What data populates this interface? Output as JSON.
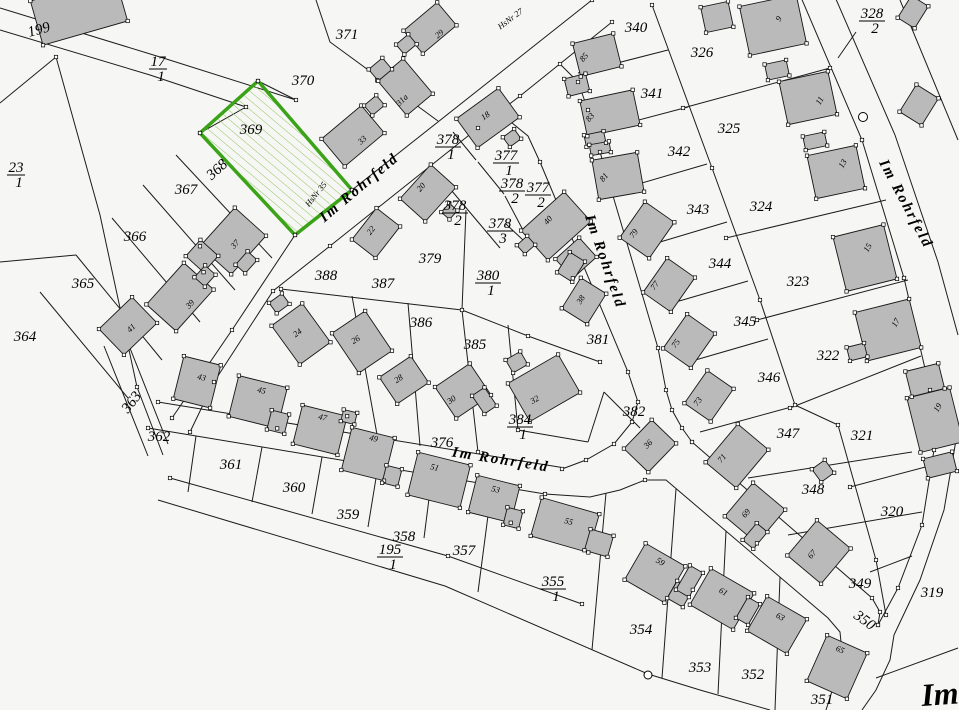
{
  "colors": {
    "background": "#f6f6f4",
    "line": "#1c1c1c",
    "building_fill": "#bababa",
    "highlight_border": "#3aa317",
    "hatch": "#8fc75c",
    "corner_label": "#5c1111"
  },
  "street_labels": {
    "name": "Im Rohrfeld",
    "hsnr27": "HsNr 27",
    "hsnr35": "HsNr 35",
    "corner": "Im"
  },
  "highlighted_parcel": "369",
  "parcel_labels": [
    "199",
    "371",
    "370",
    "369",
    "368",
    "367",
    "366",
    "365",
    "364",
    "363",
    "362",
    "361",
    "360",
    "359",
    "358",
    "357",
    "354",
    "353",
    "352",
    "351",
    "376",
    "388",
    "387",
    "386",
    "385",
    "379",
    "381",
    "382",
    "340",
    "326",
    "341",
    "325",
    "342",
    "324",
    "343",
    "344",
    "323",
    "345",
    "322",
    "346",
    "347",
    "321",
    "348",
    "320",
    "349",
    "319",
    "350"
  ],
  "fraction_labels": [
    {
      "num": "17",
      "den": "1"
    },
    {
      "num": "23",
      "den": "1"
    },
    {
      "num": "328",
      "den": "2"
    },
    {
      "num": "378",
      "den": "1"
    },
    {
      "num": "377",
      "den": "1"
    },
    {
      "num": "378",
      "den": "2"
    },
    {
      "num": "377",
      "den": "2"
    },
    {
      "num": "378",
      "den": "2"
    },
    {
      "num": "378",
      "den": "3"
    },
    {
      "num": "380",
      "den": "1"
    },
    {
      "num": "384",
      "den": "1"
    },
    {
      "num": "355",
      "den": "1"
    },
    {
      "num": "195",
      "den": "1"
    }
  ],
  "house_numbers": [
    "29",
    "31a",
    "33",
    "18",
    "20",
    "22",
    "40",
    "38",
    "36",
    "24",
    "26",
    "28",
    "30",
    "32",
    "37",
    "39",
    "41",
    "43",
    "45",
    "47",
    "49",
    "51",
    "53",
    "55",
    "59",
    "61",
    "63",
    "65",
    "67",
    "69",
    "71",
    "73",
    "75",
    "77",
    "79",
    "81",
    "83",
    "85",
    "9",
    "11",
    "13",
    "15",
    "17",
    "19"
  ]
}
